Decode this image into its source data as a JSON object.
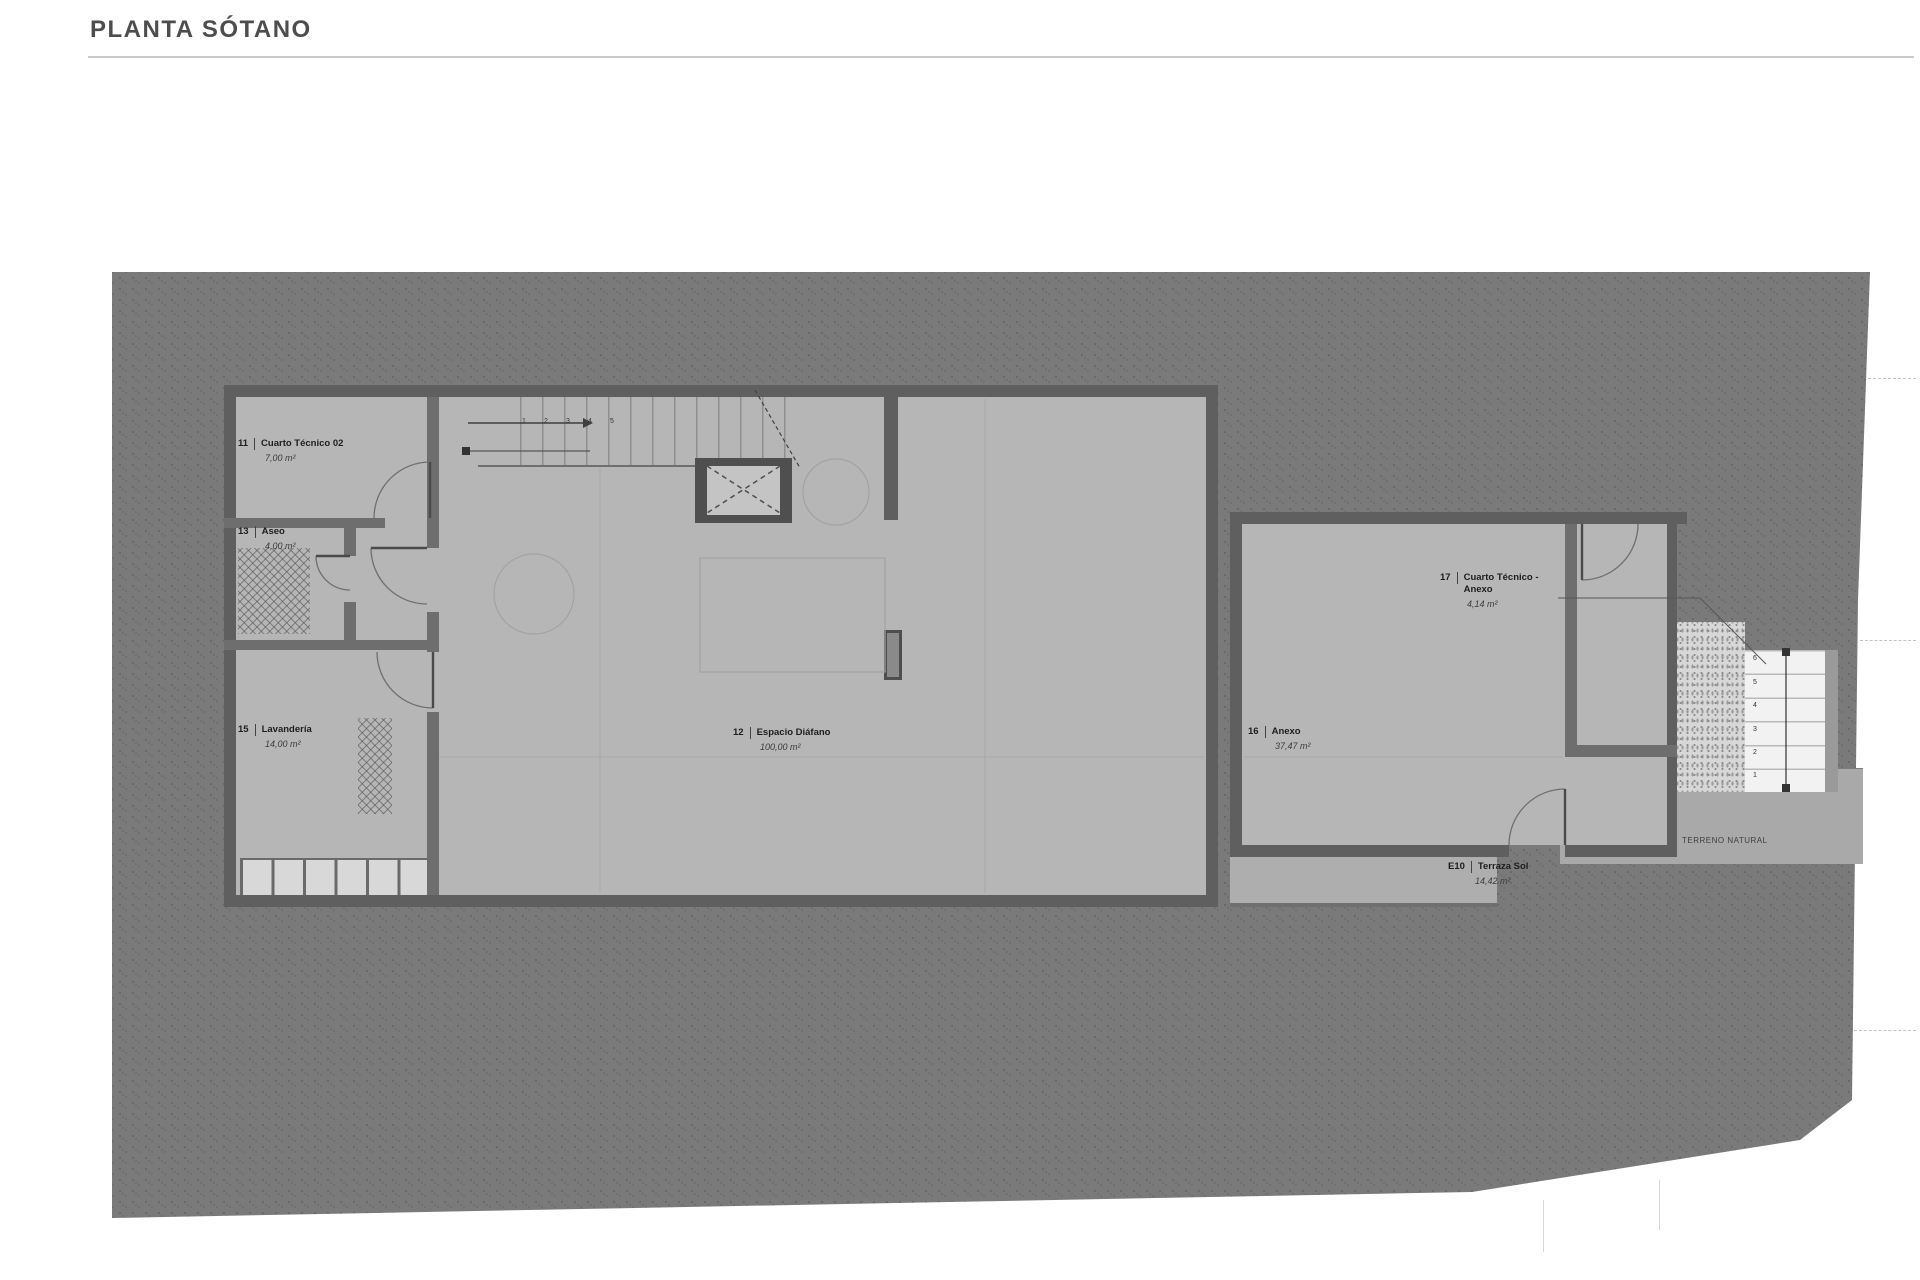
{
  "title": "PLANTA SÓTANO",
  "rooms": [
    {
      "num": "11",
      "name": "Cuarto Técnico 02",
      "area": "7,00 m²"
    },
    {
      "num": "13",
      "name": "Aseo",
      "area": "4,00 m²"
    },
    {
      "num": "15",
      "name": "Lavandería",
      "area": "14,00 m²"
    },
    {
      "num": "12",
      "name": "Espacio Diáfano",
      "area": "100,00 m²"
    },
    {
      "num": "16",
      "name": "Anexo",
      "area": "37,47 m²"
    },
    {
      "num": "17",
      "name": "Cuarto Técnico -",
      "name2": "Anexo",
      "area": "4,14 m²"
    },
    {
      "num": "E10",
      "name": "Terraza Sol",
      "area": "14,42 m²"
    }
  ],
  "annotations": {
    "terrain_label": "TERRENO NATURAL"
  },
  "stairs": {
    "main_numbers": [
      "1",
      "2",
      "3",
      "4",
      "5"
    ],
    "exterior_numbers": [
      "6",
      "5",
      "4",
      "3",
      "2",
      "1"
    ]
  },
  "colors": {
    "terrain": "#7a7a7a",
    "floor": "#b6b6b6",
    "wall": "#5f5f5f",
    "walkway": "#a9a9a9",
    "terrace": "#aeaeae"
  }
}
